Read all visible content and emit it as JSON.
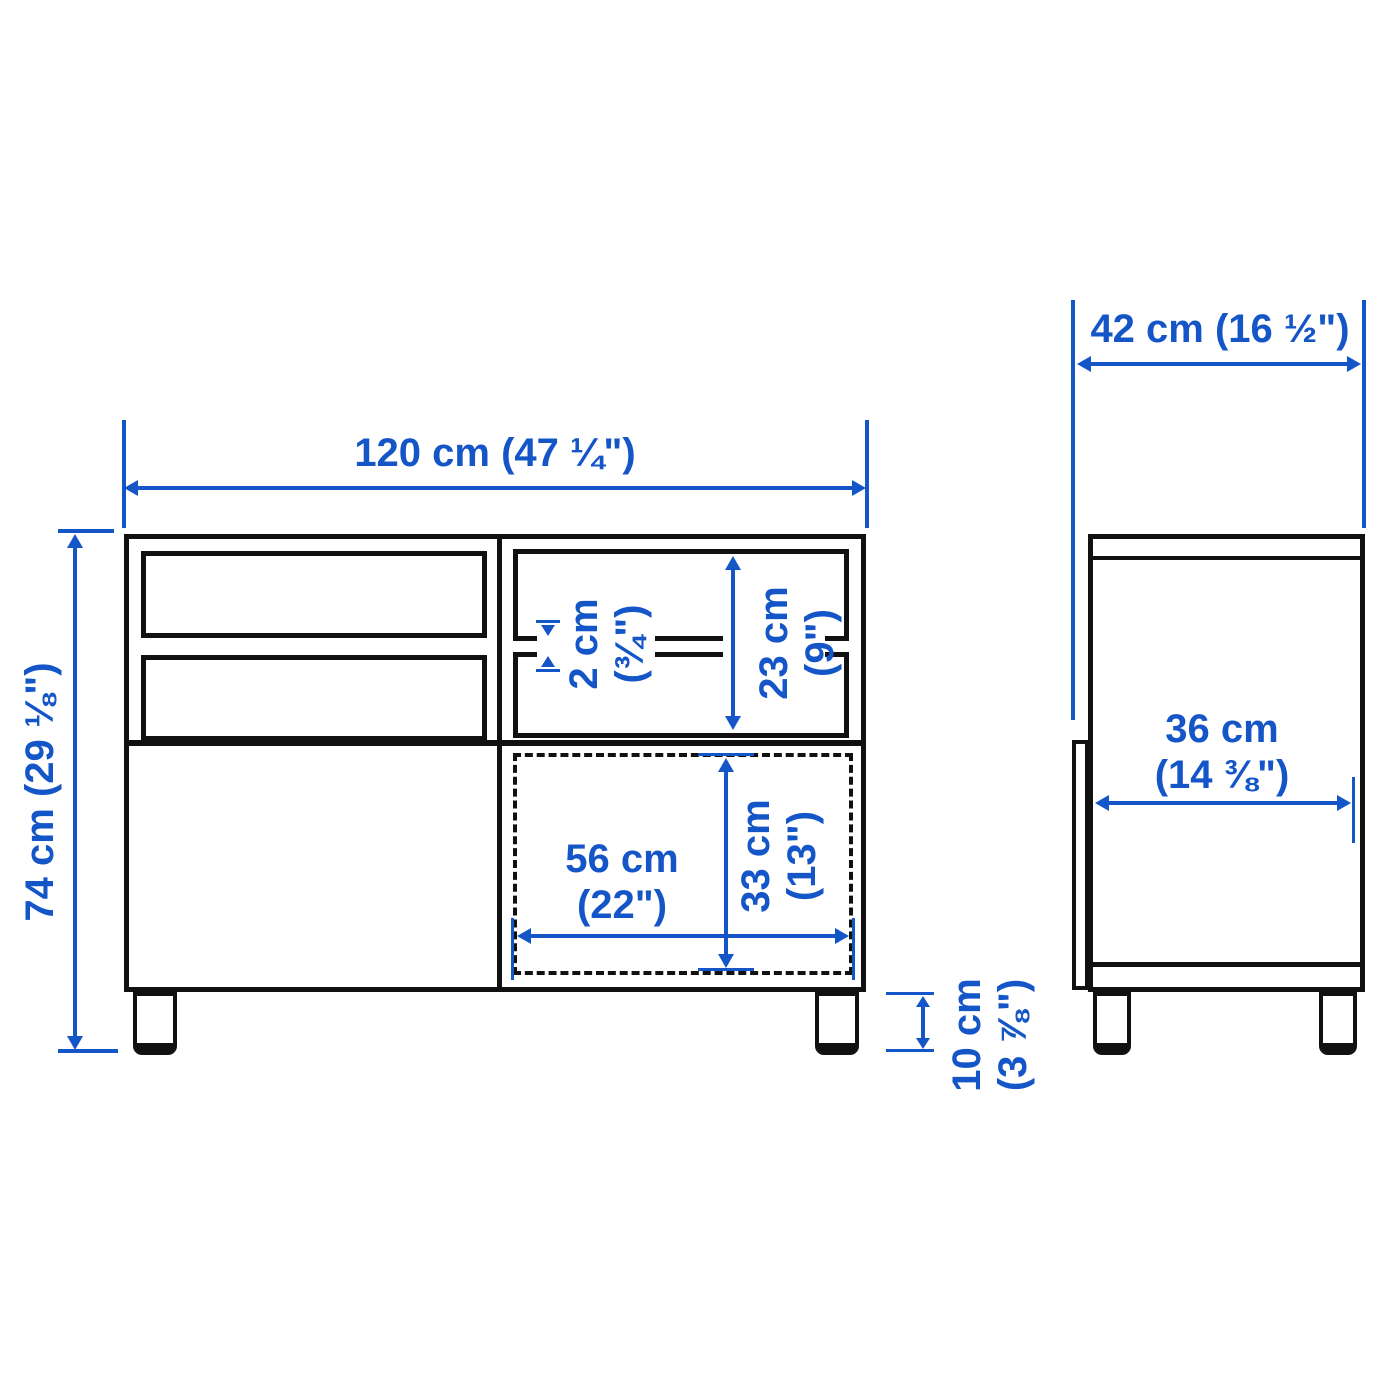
{
  "colors": {
    "accent": "#1455c8",
    "line": "#111111"
  },
  "front_view": {
    "width": "120 cm (47 ¼\")",
    "height": "74 cm (29 ⅛\")",
    "shelf_thickness_cm": "2 cm",
    "shelf_thickness_in": "(¾\")",
    "compartment_height_cm": "23 cm",
    "compartment_height_in": "(9\")",
    "opening_width_cm": "56 cm",
    "opening_width_in": "(22\")",
    "opening_height_cm": "33 cm",
    "opening_height_in": "(13\")",
    "leg_height_cm": "10 cm",
    "leg_height_in": "(3 ⅞\")"
  },
  "side_view": {
    "depth": "42 cm (16 ½\")",
    "inner_depth_cm": "36 cm",
    "inner_depth_in": "(14 ⅜\")"
  }
}
